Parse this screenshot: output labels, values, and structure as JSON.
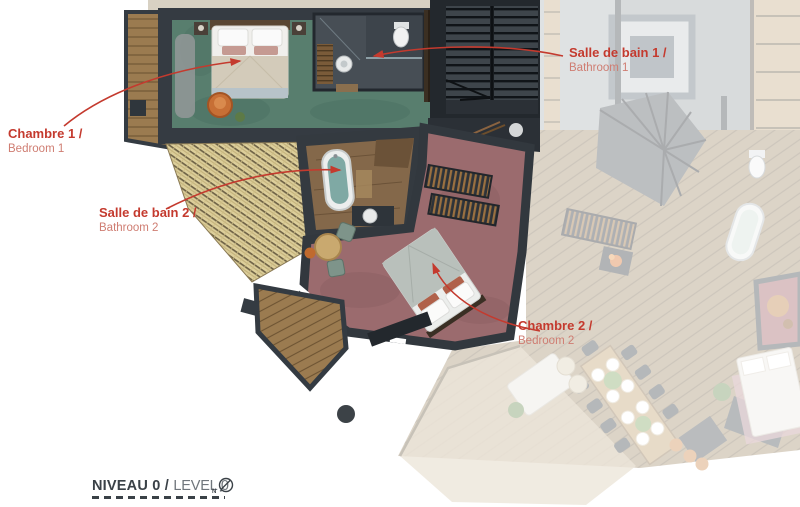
{
  "annotations": {
    "chambre1": {
      "title": "Chambre 1 /",
      "subtitle": "Bedroom 1"
    },
    "salle_de_bain1": {
      "title": "Salle de bain 1 /",
      "subtitle": "Bathroom 1"
    },
    "salle_de_bain2": {
      "title": "Salle de bain 2 /",
      "subtitle": "Bathroom 2"
    },
    "chambre2": {
      "title": "Chambre 2 /",
      "subtitle": "Bedroom 2"
    }
  },
  "footer": {
    "level_fr": "NIVEAU 0 /",
    "level_en": "LEVEL 0",
    "compass_label": "N"
  },
  "colors": {
    "accent": "#c43a2e",
    "accent-light": "#cf7d72",
    "ink": "#3a4147",
    "ink-light": "#70767c",
    "wall": "#353b42",
    "carpet-teal": "#587e6e",
    "carpet-maroon": "#9b6b6e",
    "shingle": "#ddcf9b",
    "deck-wood": "#9b7b50",
    "ghost-wood": "#a5906f"
  }
}
